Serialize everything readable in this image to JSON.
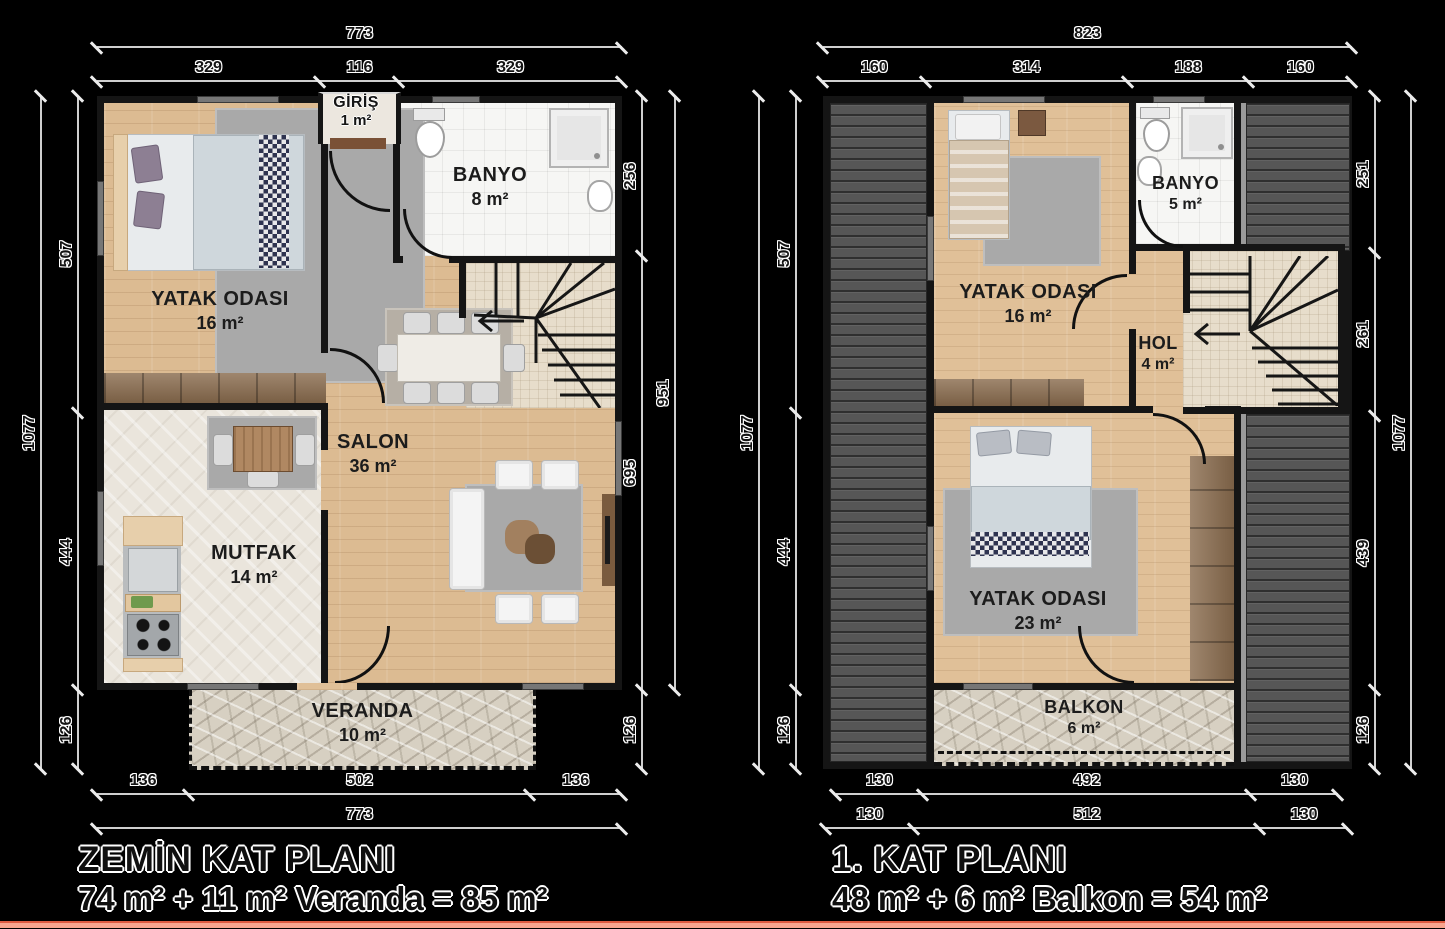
{
  "page": {
    "background": "#000000",
    "footer_line_color": "#f7a58f"
  },
  "ground_floor": {
    "title": "ZEMİN KAT PLANI",
    "subtitle": "74 m² + 11 m² Veranda = 85 m²",
    "rooms": {
      "bedroom": {
        "name": "YATAK ODASI",
        "area": "16 m²"
      },
      "bathroom": {
        "name": "BANYO",
        "area": "8 m²"
      },
      "entry": {
        "name": "GİRİŞ",
        "area": "1 m²"
      },
      "living": {
        "name": "SALON",
        "area": "36 m²"
      },
      "kitchen": {
        "name": "MUTFAK",
        "area": "14 m²"
      },
      "veranda": {
        "name": "VERANDA",
        "area": "10 m²"
      }
    },
    "dims": {
      "top_total": "773",
      "top": [
        "329",
        "116",
        "329"
      ],
      "left_total": "1077",
      "left": [
        "507",
        "444",
        "126"
      ],
      "right": [
        "256",
        "695",
        "126"
      ],
      "right_total": "951",
      "bottom": [
        "136",
        "502",
        "136"
      ],
      "bottom_total": "773"
    }
  },
  "first_floor": {
    "title": "1. KAT PLANI",
    "subtitle": "48 m² + 6 m² Balkon = 54 m²",
    "rooms": {
      "bedroom1": {
        "name": "YATAK ODASI",
        "area": "16 m²"
      },
      "bathroom": {
        "name": "BANYO",
        "area": "5 m²"
      },
      "hall": {
        "name": "HOL",
        "area": "4 m²"
      },
      "bedroom2": {
        "name": "YATAK ODASI",
        "area": "23 m²"
      },
      "balcony": {
        "name": "BALKON",
        "area": "6 m²"
      }
    },
    "dims": {
      "top_total": "823",
      "top": [
        "160",
        "314",
        "188",
        "160"
      ],
      "left_total": "1077",
      "left": [
        "507",
        "444",
        "126"
      ],
      "right": [
        "251",
        "261",
        "439",
        "126"
      ],
      "right_total": "1077",
      "bottom_upper": [
        "130",
        "492",
        "130"
      ],
      "bottom_lower": [
        "130",
        "512",
        "130"
      ]
    }
  }
}
